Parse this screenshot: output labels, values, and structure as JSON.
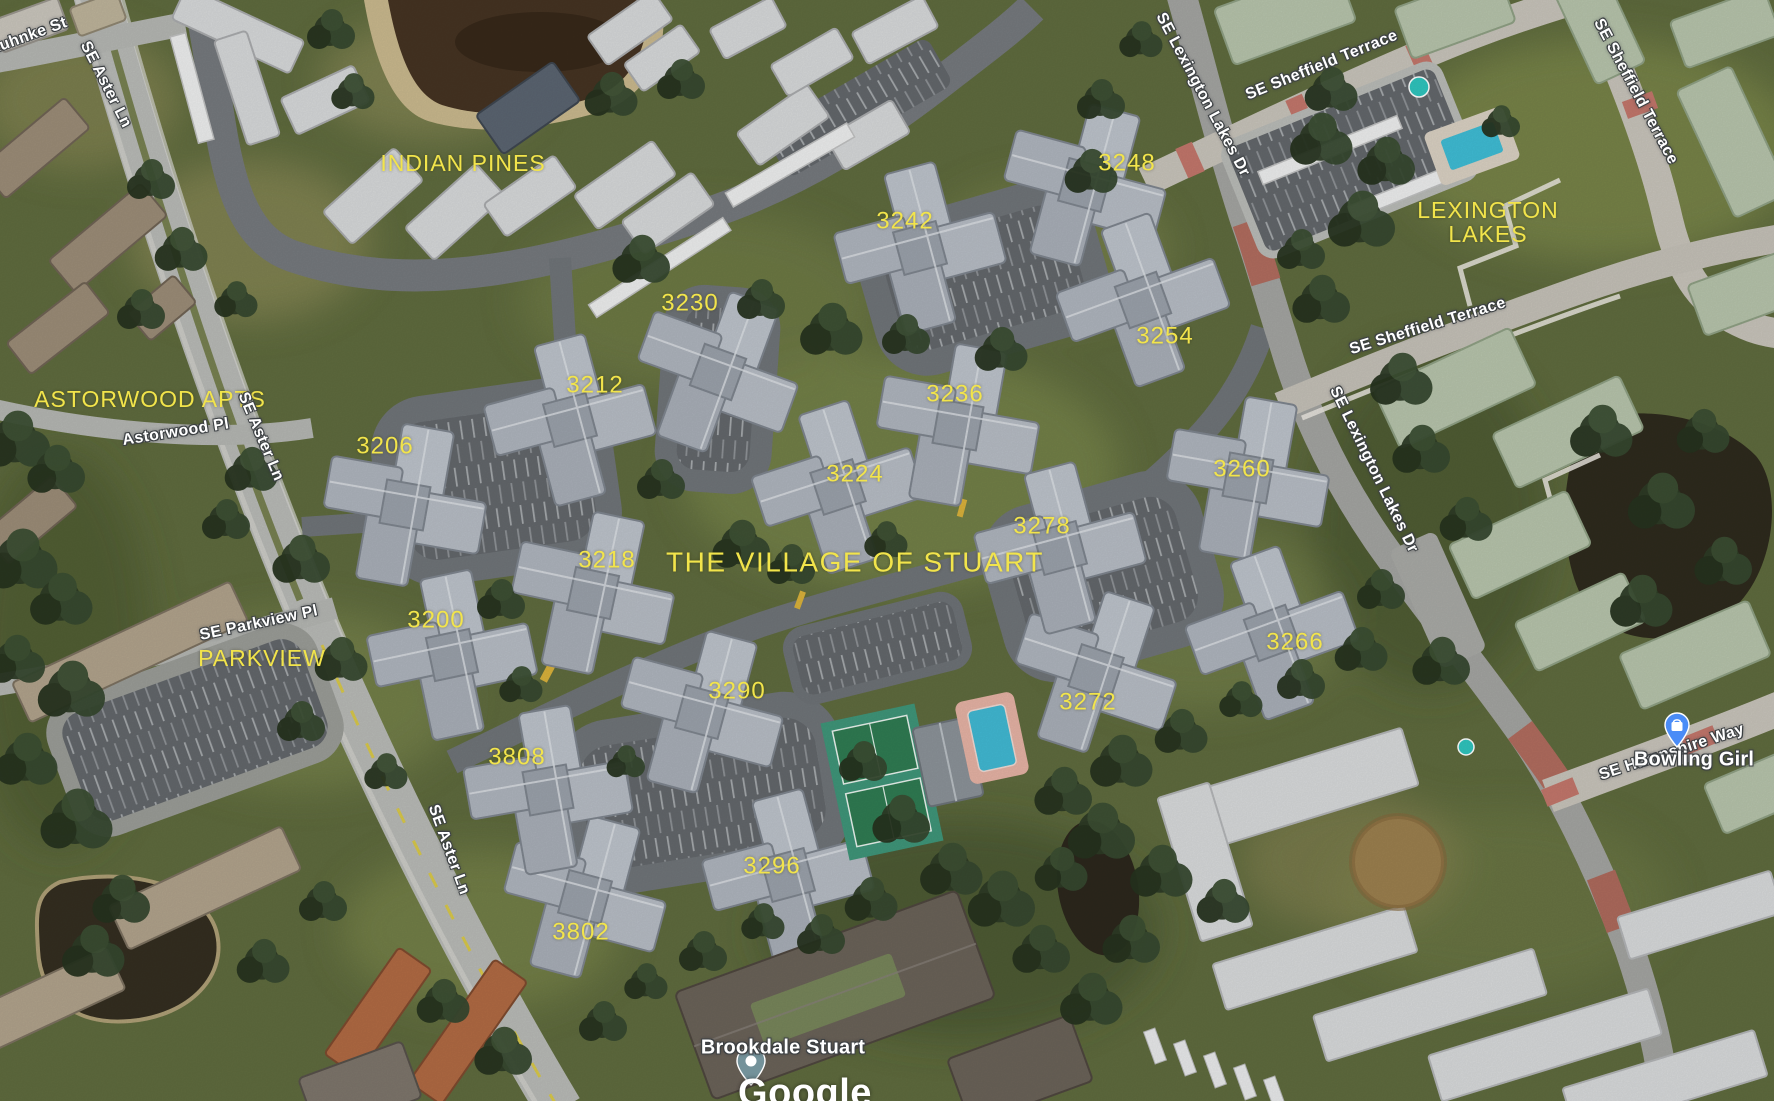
{
  "map": {
    "type": "satellite",
    "provider": "Google"
  },
  "areas": {
    "indian_pines": "INDIAN PINES",
    "astorwood_apts": "ASTORWOOD APTS",
    "parkview": "PARKVIEW",
    "village_of_stuart": "THE VILLAGE OF STUART",
    "lexington_lakes": [
      "LEXINGTON",
      "LAKES"
    ]
  },
  "streets": {
    "ruhnke_st": "Ruhnke St",
    "se_aster_ln": "SE Aster Ln",
    "astorwood_pl": "Astorwood Pl",
    "se_parkview_pl": "SE Parkview Pl",
    "se_lexington_lakes_dr": "SE Lexington Lakes Dr",
    "se_sheffield_terrace": "SE Sheffield Terrace",
    "se_hampshire_way": "SE Hampshire Way"
  },
  "buildings": {
    "numbers": [
      "3200",
      "3206",
      "3212",
      "3218",
      "3224",
      "3230",
      "3236",
      "3242",
      "3248",
      "3254",
      "3260",
      "3266",
      "3272",
      "3278",
      "3290",
      "3296",
      "3802",
      "3808"
    ]
  },
  "pois": {
    "bowling_girl": "Bowling Girl",
    "brookdale_stuart": "Brookdale Stuart"
  },
  "attribution": {
    "logo": "Google"
  },
  "icons": {
    "blue_pin": "shopping-bag-pin",
    "gray_pin": "place-pin"
  },
  "colors": {
    "area_label": "#f2e44b",
    "street_label": "#ffffff",
    "shopping_pin_blue": "#4a8cf7",
    "place_pin_gray": "#74929a"
  }
}
